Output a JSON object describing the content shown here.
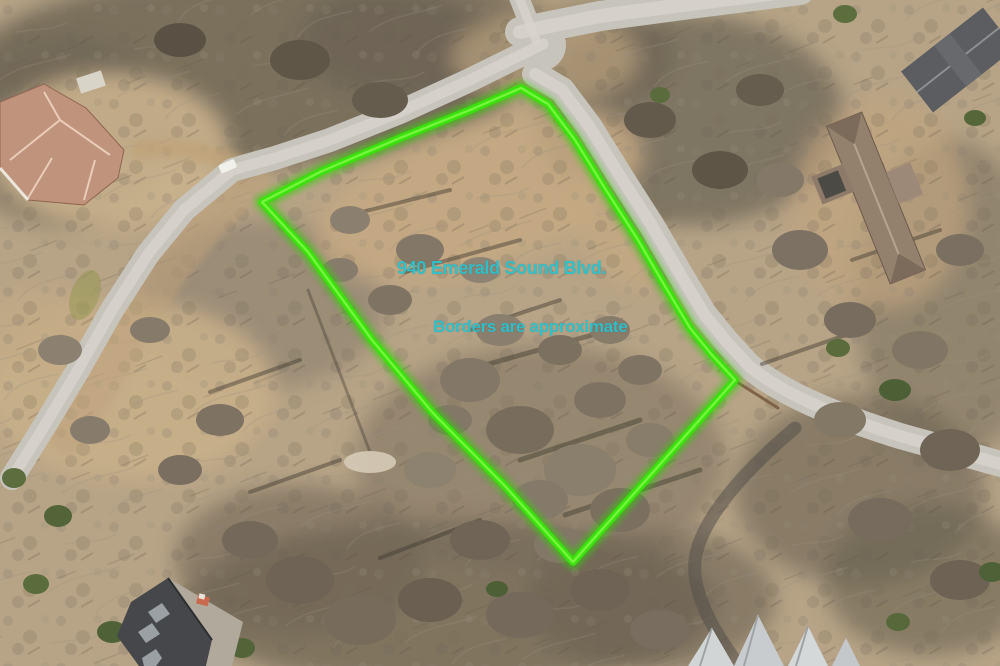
{
  "annotations": {
    "address_label": "940 Emerald Sound Blvd.",
    "disclaimer_label": "Borders are approximate",
    "label_color": "#2cc3ce",
    "border_color": "#3be10c",
    "border_glow_color": "#2ed400",
    "border_highlight_color": "#90ff55",
    "border_points": [
      [
        262,
        202
      ],
      [
        320,
        172
      ],
      [
        400,
        138
      ],
      [
        470,
        110
      ],
      [
        521,
        88
      ],
      [
        548,
        104
      ],
      [
        575,
        140
      ],
      [
        606,
        190
      ],
      [
        638,
        240
      ],
      [
        666,
        288
      ],
      [
        690,
        328
      ],
      [
        712,
        355
      ],
      [
        735,
        380
      ],
      [
        655,
        470
      ],
      [
        573,
        562
      ],
      [
        505,
        486
      ],
      [
        432,
        412
      ],
      [
        372,
        340
      ],
      [
        308,
        252
      ]
    ]
  }
}
